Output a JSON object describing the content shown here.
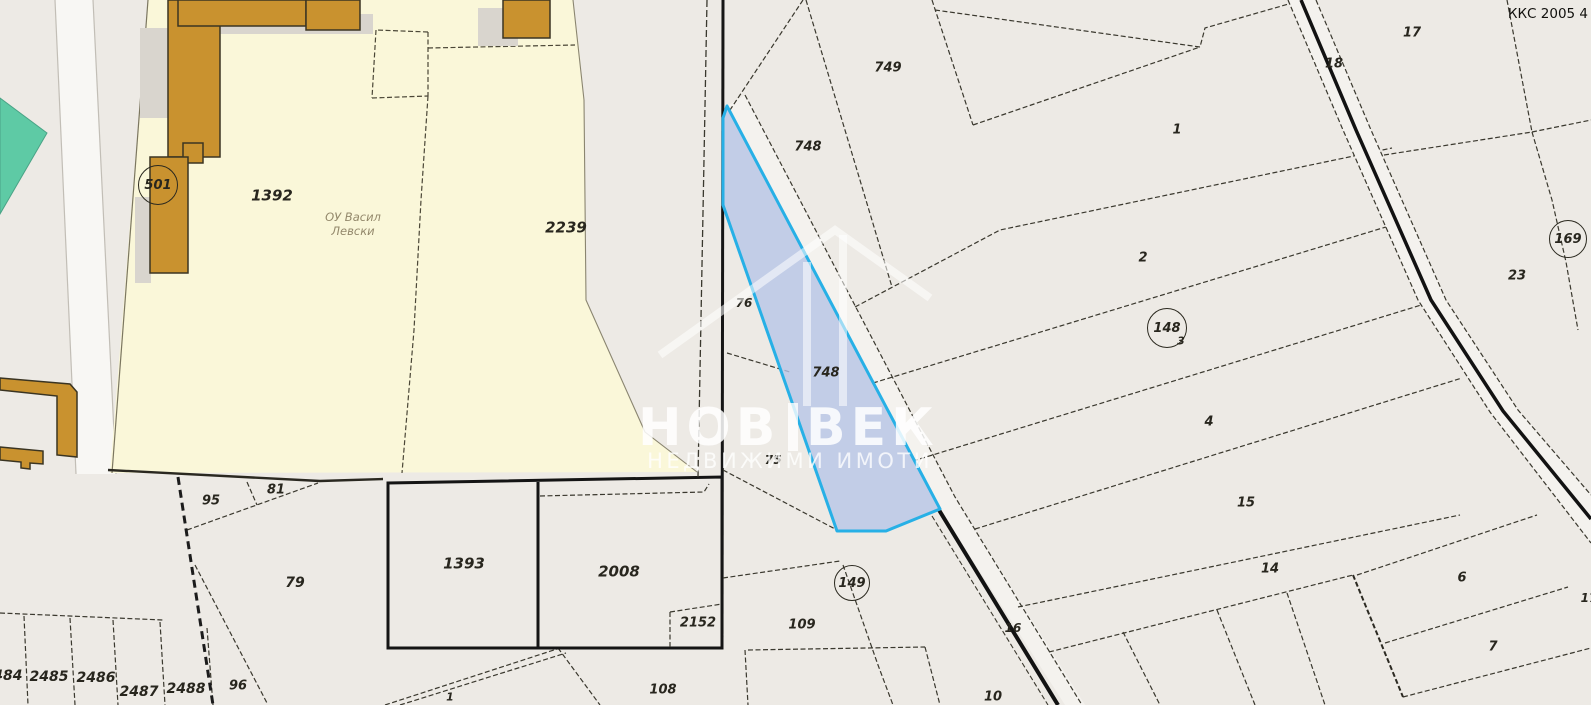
{
  "map": {
    "corner_code": "ККС 2005 4",
    "watermark": {
      "title_left": "НОВ",
      "title_right": "ВЕК",
      "subtitle": "НЕДВИЖИМИ ИМОТИ"
    },
    "school_label": {
      "line1": "ОУ Васил",
      "line2": "Левски"
    },
    "colors": {
      "background": "#edeae5",
      "parcel_block_yellow": "#faf7d9",
      "building_brown": "#c9922f",
      "greenery_teal": "#5ecaa5",
      "highlight_fill": "#b7c5e7",
      "highlight_stroke": "#27b0e6"
    },
    "highlighted_parcel": {
      "number": "748"
    },
    "labels": [
      {
        "t": "1392",
        "x": 272,
        "y": 196,
        "fs": 15
      },
      {
        "t": "2239",
        "x": 566,
        "y": 228,
        "fs": 15
      },
      {
        "t": "95",
        "x": 211,
        "y": 501,
        "fs": 13
      },
      {
        "t": "81",
        "x": 276,
        "y": 490,
        "fs": 13
      },
      {
        "t": "79",
        "x": 295,
        "y": 583,
        "fs": 14
      },
      {
        "t": "2484",
        "x": 3,
        "y": 676,
        "fs": 14
      },
      {
        "t": "2485",
        "x": 49,
        "y": 677,
        "fs": 14
      },
      {
        "t": "2486",
        "x": 96,
        "y": 678,
        "fs": 14
      },
      {
        "t": "2487",
        "x": 139,
        "y": 692,
        "fs": 14
      },
      {
        "t": "2488",
        "x": 186,
        "y": 689,
        "fs": 14
      },
      {
        "t": "96",
        "x": 238,
        "y": 686,
        "fs": 13
      },
      {
        "t": "1393",
        "x": 464,
        "y": 564,
        "fs": 15
      },
      {
        "t": "2008",
        "x": 619,
        "y": 572,
        "fs": 15
      },
      {
        "t": "2152",
        "x": 698,
        "y": 623,
        "fs": 13
      },
      {
        "t": "108",
        "x": 663,
        "y": 690,
        "fs": 13
      },
      {
        "t": "1",
        "x": 450,
        "y": 697,
        "fs": 11
      },
      {
        "t": "76",
        "x": 744,
        "y": 303,
        "fs": 12
      },
      {
        "t": "75",
        "x": 773,
        "y": 460,
        "fs": 12
      },
      {
        "t": "748",
        "x": 826,
        "y": 373,
        "fs": 13
      },
      {
        "t": "748",
        "x": 808,
        "y": 147,
        "fs": 13
      },
      {
        "t": "749",
        "x": 888,
        "y": 68,
        "fs": 13
      },
      {
        "t": "1",
        "x": 1177,
        "y": 130,
        "fs": 13
      },
      {
        "t": "2",
        "x": 1143,
        "y": 258,
        "fs": 13
      },
      {
        "t": "3",
        "x": 1181,
        "y": 341,
        "fs": 11
      },
      {
        "t": "4",
        "x": 1209,
        "y": 422,
        "fs": 13
      },
      {
        "t": "15",
        "x": 1246,
        "y": 503,
        "fs": 13
      },
      {
        "t": "14",
        "x": 1270,
        "y": 569,
        "fs": 13
      },
      {
        "t": "6",
        "x": 1462,
        "y": 578,
        "fs": 13
      },
      {
        "t": "7",
        "x": 1493,
        "y": 647,
        "fs": 13
      },
      {
        "t": "10",
        "x": 993,
        "y": 697,
        "fs": 13
      },
      {
        "t": "16",
        "x": 1013,
        "y": 628,
        "fs": 12
      },
      {
        "t": "109",
        "x": 802,
        "y": 625,
        "fs": 13
      },
      {
        "t": "17",
        "x": 1412,
        "y": 33,
        "fs": 13
      },
      {
        "t": "18",
        "x": 1334,
        "y": 64,
        "fs": 13
      },
      {
        "t": "23",
        "x": 1517,
        "y": 276,
        "fs": 13
      },
      {
        "t": "17",
        "x": 1589,
        "y": 598,
        "fs": 12
      }
    ],
    "circled_labels": [
      {
        "t": "501",
        "x": 158,
        "y": 185,
        "r": 19
      },
      {
        "t": "148",
        "x": 1167,
        "y": 328,
        "r": 19
      },
      {
        "t": "149",
        "x": 852,
        "y": 583,
        "r": 17
      },
      {
        "t": "169",
        "x": 1568,
        "y": 239,
        "r": 18
      }
    ]
  }
}
